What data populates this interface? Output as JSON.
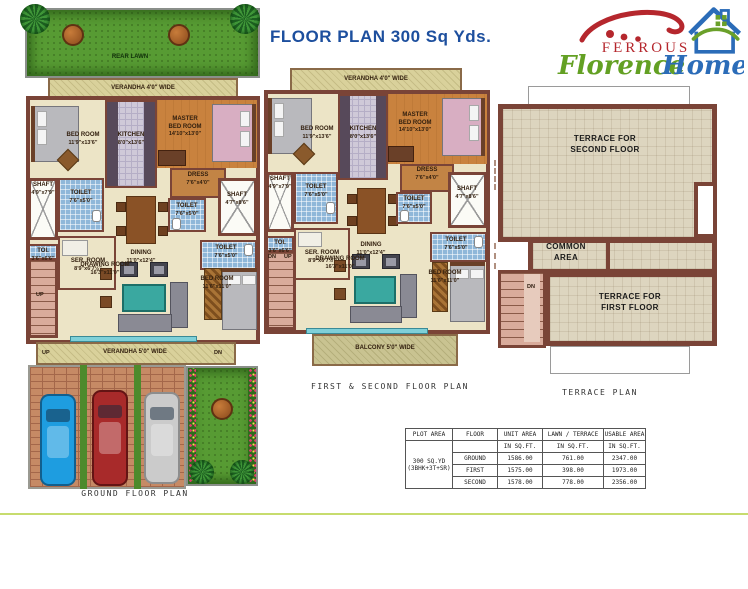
{
  "page": {
    "title": "FLOOR PLAN 300 Sq Yds."
  },
  "logo": {
    "ferrous": "FERROUS",
    "florence": "Florence",
    "homes": "Homes",
    "colors": {
      "red": "#b5272d",
      "green": "#63a023",
      "blue": "#2b6cb8"
    }
  },
  "plans": {
    "ground": {
      "caption": "GROUND FLOOR PLAN",
      "labels": {
        "rear_lawn": "REAR LAWN",
        "verandha_top": "VERANDHA 4'0\" WIDE",
        "bed_room": "BED ROOM",
        "bed_room_dim": "11'9\"x13'6\"",
        "kitchen": "KITCHEN",
        "kitchen_dim": "8'0\"x13'6\"",
        "master_1": "MASTER",
        "master_2": "BED ROOM",
        "master_dim": "14'10\"x13'0\"",
        "dress": "DRESS",
        "dress_dim": "7'6\"x4'0\"",
        "shaft_left": "SHAFT",
        "shaft_left_dim": "4'9\"x7'9\"",
        "toilet_left": "TOILET",
        "toilet_left_dim": "7'6\"x5'0\"",
        "toi": "TOI.",
        "toi_dim": "3'6\"x6'6\"",
        "ser_room": "SER. ROOM",
        "ser_room_dim": "8'9\"x6'7½\"",
        "dining": "DINING",
        "dining_dim": "11'0\"x12'4\"",
        "toilet_right_top": "TOILET",
        "toilet_right_top_dim": "7'6\"x5'0\"",
        "shaft_right": "SHAFT",
        "shaft_right_dim": "4'7\"x8'6\"",
        "toilet_right_bottom": "TOILET",
        "toilet_right_bottom_dim": "7'6\"x5'0\"",
        "drawing_room": "DRAWING ROOM",
        "drawing_room_dim": "16'3\"x11'0\"",
        "bed_room_2": "BED ROOM",
        "bed_room_2_dim": "11'6\"x11'0\"",
        "verandha_bottom": "VERANDHA 5'0\" WIDE",
        "up": "UP",
        "dn": "DN"
      }
    },
    "first_second": {
      "caption": "FIRST & SECOND FLOOR PLAN",
      "labels": {
        "verandha_top": "VERANDHA 4'0\" WIDE",
        "bed_room": "BED ROOM",
        "bed_room_dim": "11'9\"x13'6\"",
        "kitchen": "KITCHEN",
        "kitchen_dim": "8'0\"x13'6\"",
        "master_1": "MASTER",
        "master_2": "BED ROOM",
        "master_dim": "14'10\"x13'0\"",
        "dress": "DRESS",
        "dress_dim": "7'6\"x4'0\"",
        "shaft_left": "SHAFT",
        "shaft_left_dim": "4'9\"x7'9\"",
        "toilet_left": "TOILET",
        "toilet_left_dim": "7'6\"x5'0\"",
        "toi": "TOI.",
        "toi_dim": "3'6\"x6'6\"",
        "ser_room": "SER. ROOM",
        "ser_room_dim": "8'9\"x6'7½\"",
        "dining": "DINING",
        "dining_dim": "11'0\"x12'4\"",
        "toilet_right_top": "TOILET",
        "toilet_right_top_dim": "7'6\"x5'0\"",
        "shaft_right": "SHAFT",
        "shaft_right_dim": "4'7\"x8'6\"",
        "toilet_right_bottom": "TOILET",
        "toilet_right_bottom_dim": "7'6\"x5'0\"",
        "drawing_room": "DRAWING ROOM",
        "drawing_room_dim": "16'3\"x11'0\"",
        "bed_room_2": "BED ROOM",
        "bed_room_2_dim": "11'6\"x11'0\"",
        "balcony": "BALCONY 5'0\" WIDE",
        "up": "UP",
        "dn": "DN"
      }
    },
    "terrace": {
      "caption": "TERRACE PLAN",
      "labels": {
        "terrace_second_1": "TERRACE FOR",
        "terrace_second_2": "SECOND FLOOR",
        "common_1": "COMMON",
        "common_2": "AREA",
        "terrace_first_1": "TERRACE FOR",
        "terrace_first_2": "FIRST FLOOR",
        "dn": "DN"
      }
    }
  },
  "table": {
    "headers": [
      "PLOT AREA",
      "FLOOR",
      "UNIT AREA",
      "LAWN / TERRACE",
      "USABLE AREA"
    ],
    "unit_label": "IN SQ.FT.",
    "plot_area_line1": "300 SQ.YD",
    "plot_area_line2": "(3BHK+3T+SR)",
    "rows": [
      {
        "floor": "GROUND",
        "unit_area": "1586.00",
        "lawn_terrace": "761.00",
        "usable_area": "2347.00"
      },
      {
        "floor": "FIRST",
        "unit_area": "1575.00",
        "lawn_terrace": "398.00",
        "usable_area": "1973.00"
      },
      {
        "floor": "SECOND",
        "unit_area": "1578.00",
        "lawn_terrace": "778.00",
        "usable_area": "2356.00"
      }
    ]
  }
}
